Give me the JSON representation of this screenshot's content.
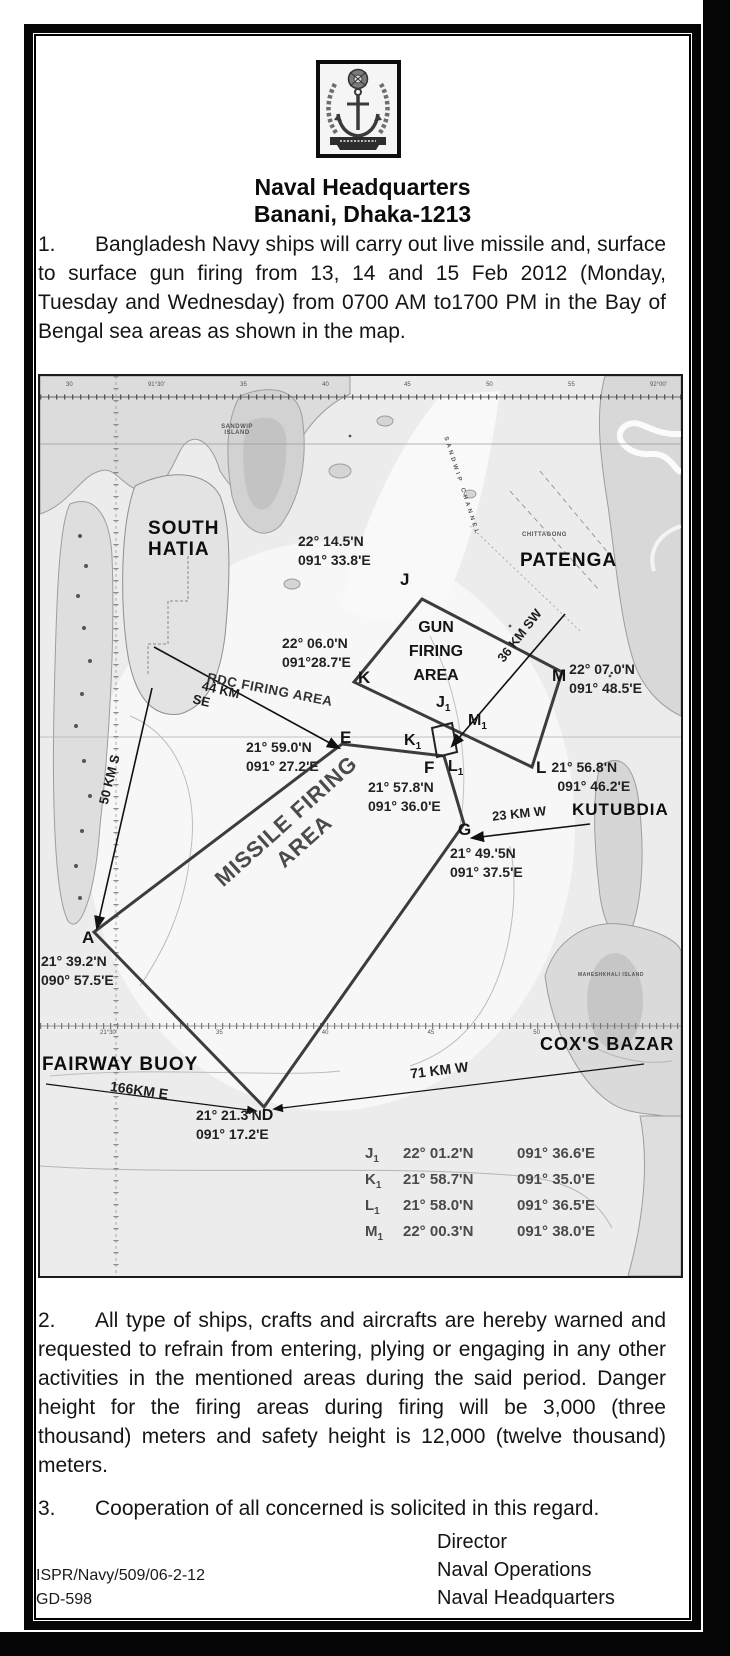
{
  "colors": {
    "page_bg": "#ffffff",
    "frame": "#000000",
    "map_bg": "#ececec",
    "land": "#d8d8d8",
    "label": "#111111"
  },
  "doc": {
    "title1": "Naval Headquarters",
    "title2": "Banani, Dhaka-1213",
    "para1": {
      "num": "1.",
      "text": "Bangladesh Navy ships will carry out live missile and, surface to surface gun firing from 13, 14 and 15 Feb 2012 (Monday, Tuesday and Wednesday) from 0700 AM to1700 PM in the Bay of Bengal sea areas as shown in the map."
    },
    "para2": {
      "num": "2.",
      "text": "All type of ships, crafts and aircrafts are hereby warned and requested to refrain from entering, plying or engaging in any other activities in the mentioned areas during the said period. Danger height for the firing areas during firing will be 3,000 (three thousand) meters and safety height is 12,000 (twelve thousand) meters."
    },
    "para3": {
      "num": "3.",
      "text": "Cooperation of all concerned is solicited in this regard."
    },
    "footer": {
      "ref1": "ISPR/Navy/509/06-2-12",
      "ref2": "GD-598",
      "sig1": "Director",
      "sig2": "Naval Operations",
      "sig3": "Naval Headquarters"
    }
  },
  "map": {
    "ruler": {
      "top": [
        "30",
        "91°30'",
        "35",
        "40",
        "45",
        "50",
        "55",
        "92°00'"
      ],
      "mid": [
        "21°30'",
        "35",
        "40",
        "45",
        "50"
      ]
    },
    "tiny": {
      "sandwip_island": "SANDWIP ISLAND",
      "sandwip_channel": "SANDWIP CHANNEL",
      "chittagong": "CHITTAGONG",
      "maheshkhali": "MAHESHKHALI ISLAND"
    },
    "places": {
      "south_hatia_1": "SOUTH",
      "south_hatia_2": "HATIA",
      "patenga": "PATENGA",
      "kutubdia": "KUTUBDIA",
      "coxs_bazar": "COX'S BAZAR",
      "fairway_buoy": "FAIRWAY BUOY"
    },
    "areas": {
      "gun_1": "GUN",
      "gun_2": "FIRING",
      "gun_3": "AREA",
      "rdc": "RDC FIRING AREA",
      "missile_1": "MISSILE FIRING",
      "missile_2": "AREA"
    },
    "distances": {
      "d44a": "44 KM",
      "d44b": "SE",
      "d50": "50 KM S",
      "d36": "36 KM SW",
      "d23": "23 KM W",
      "d71": "71 KM W",
      "d166": "166KM E"
    },
    "points": {
      "J": {
        "id": "J",
        "lat": "22° 14.5'N",
        "lon": "091° 33.8'E"
      },
      "K": {
        "id": "K",
        "lat": "22° 06.0'N",
        "lon": "091°28.7'E"
      },
      "E": {
        "id": "E",
        "lat": "21° 59.0'N",
        "lon": "091° 27.2'E"
      },
      "F": {
        "id": "F",
        "lat": "21° 57.8'N",
        "lon": "091° 36.0'E"
      },
      "G": {
        "id": "G",
        "lat": "21° 49.'5N",
        "lon": "091° 37.5'E"
      },
      "L": {
        "id": "L",
        "lat": "21° 56.8'N",
        "lon": "091° 46.2'E"
      },
      "M": {
        "id": "M",
        "lat": "22° 07.0'N",
        "lon": "091° 48.5'E"
      },
      "A": {
        "id": "A",
        "lat": "21° 39.2'N",
        "lon": "090° 57.5'E"
      },
      "D": {
        "id": "D",
        "lat": "21° 21.3'N",
        "lon": "091° 17.2'E"
      }
    },
    "sub_points": {
      "J1": {
        "base": "J",
        "sub": "1"
      },
      "K1": {
        "base": "K",
        "sub": "1"
      },
      "L1": {
        "base": "L",
        "sub": "1"
      },
      "M1": {
        "base": "M",
        "sub": "1"
      }
    },
    "table": {
      "rows": [
        {
          "id": "J",
          "sub": "1",
          "lat": "22° 01.2'N",
          "lon": "091° 36.6'E"
        },
        {
          "id": "K",
          "sub": "1",
          "lat": "21° 58.7'N",
          "lon": "091° 35.0'E"
        },
        {
          "id": "L",
          "sub": "1",
          "lat": "21° 58.0'N",
          "lon": "091° 36.5'E"
        },
        {
          "id": "M",
          "sub": "1",
          "lat": "22° 00.3'N",
          "lon": "091° 38.0'E"
        }
      ]
    }
  }
}
